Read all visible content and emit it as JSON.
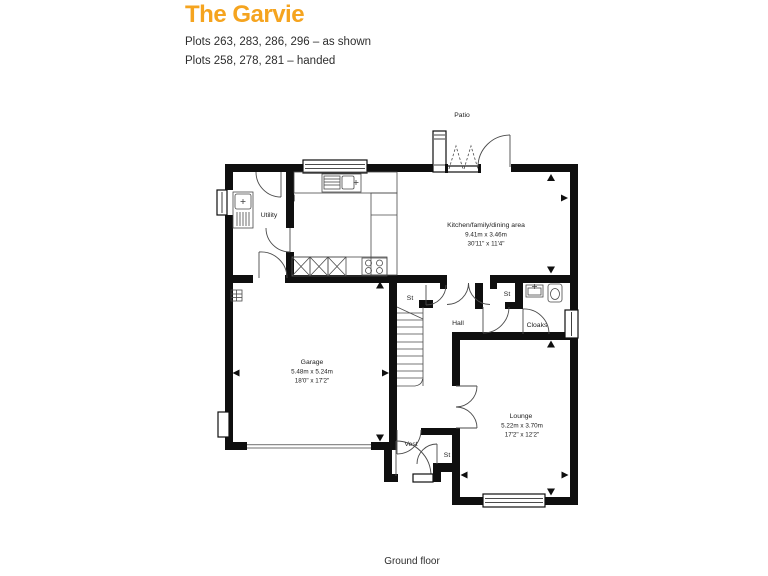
{
  "header": {
    "title": "The Garvie",
    "plots_line1": "Plots 263, 283, 286, 296 – as shown",
    "plots_line2": "Plots 258, 278, 281 – handed"
  },
  "plan": {
    "patio_label": "Patio",
    "ground_floor_label": "Ground floor",
    "rooms": {
      "kitchen": {
        "name": "Kitchen/family/dining area",
        "metric": "9.41m x 3.46m",
        "imperial": "30'11\" x 11'4\""
      },
      "utility": {
        "name": "Utility"
      },
      "garage": {
        "name": "Garage",
        "metric": "5.48m x 5.24m",
        "imperial": "18'0\" x 17'2\""
      },
      "hall": {
        "name": "Hall"
      },
      "cloaks": {
        "name": "Cloaks"
      },
      "lounge": {
        "name": "Lounge",
        "metric": "5.22m x 3.70m",
        "imperial": "17'2\" x 12'2\""
      },
      "store_top_left": {
        "name": "St"
      },
      "store_top_right": {
        "name": "St"
      },
      "store_bottom": {
        "name": "St"
      },
      "vestibule": {
        "name": "Vest"
      }
    }
  },
  "colors": {
    "accent": "#F5A41F",
    "text": "#2E2E2E",
    "wall": "#0F0F0F"
  }
}
